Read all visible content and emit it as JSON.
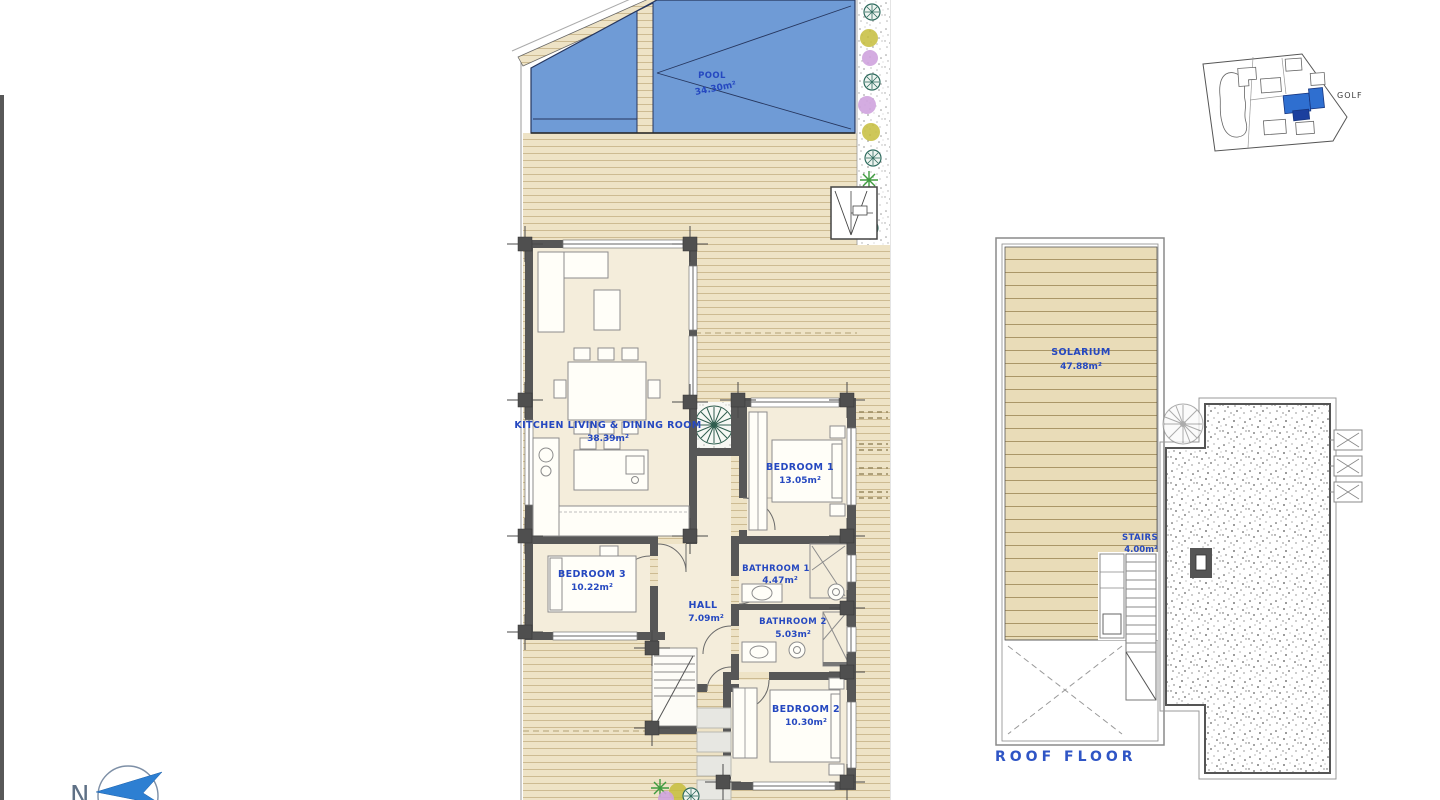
{
  "ground_floor": {
    "pool": {
      "name": "POOL",
      "area": "34.30m²"
    },
    "kitchen_living_dining": {
      "name": "KITCHEN  LIVING  &  DINING   ROOM",
      "area": "38.39m²"
    },
    "bedroom1": {
      "name": "BEDROOM  1",
      "area": "13.05m²"
    },
    "bedroom3": {
      "name": "BEDROOM  3",
      "area": "10.22m²"
    },
    "bathroom1": {
      "name": "BATHROOM  1",
      "area": "4.47m²"
    },
    "hall": {
      "name": "HALL",
      "area": "7.09m²"
    },
    "bathroom2": {
      "name": "BATHROOM  2",
      "area": "5.03m²"
    },
    "bedroom2": {
      "name": "BEDROOM  2",
      "area": "10.30m²"
    }
  },
  "roof_floor": {
    "title": "ROOF  FLOOR",
    "solarium": {
      "name": "SOLARIUM",
      "area": "47.88m²"
    },
    "stairs": {
      "name": "STAIRS",
      "area": "4.00m²"
    }
  },
  "site_map": {
    "area_label": "GOLF"
  },
  "compass": {
    "north_label": "N"
  },
  "colors": {
    "pool_blue": "#6f9bd6",
    "deck_tan": "#eee3c6",
    "wall_gray": "#575757",
    "label_blue": "#2548c0",
    "map_highlight_blue": "#2f6fd0"
  }
}
